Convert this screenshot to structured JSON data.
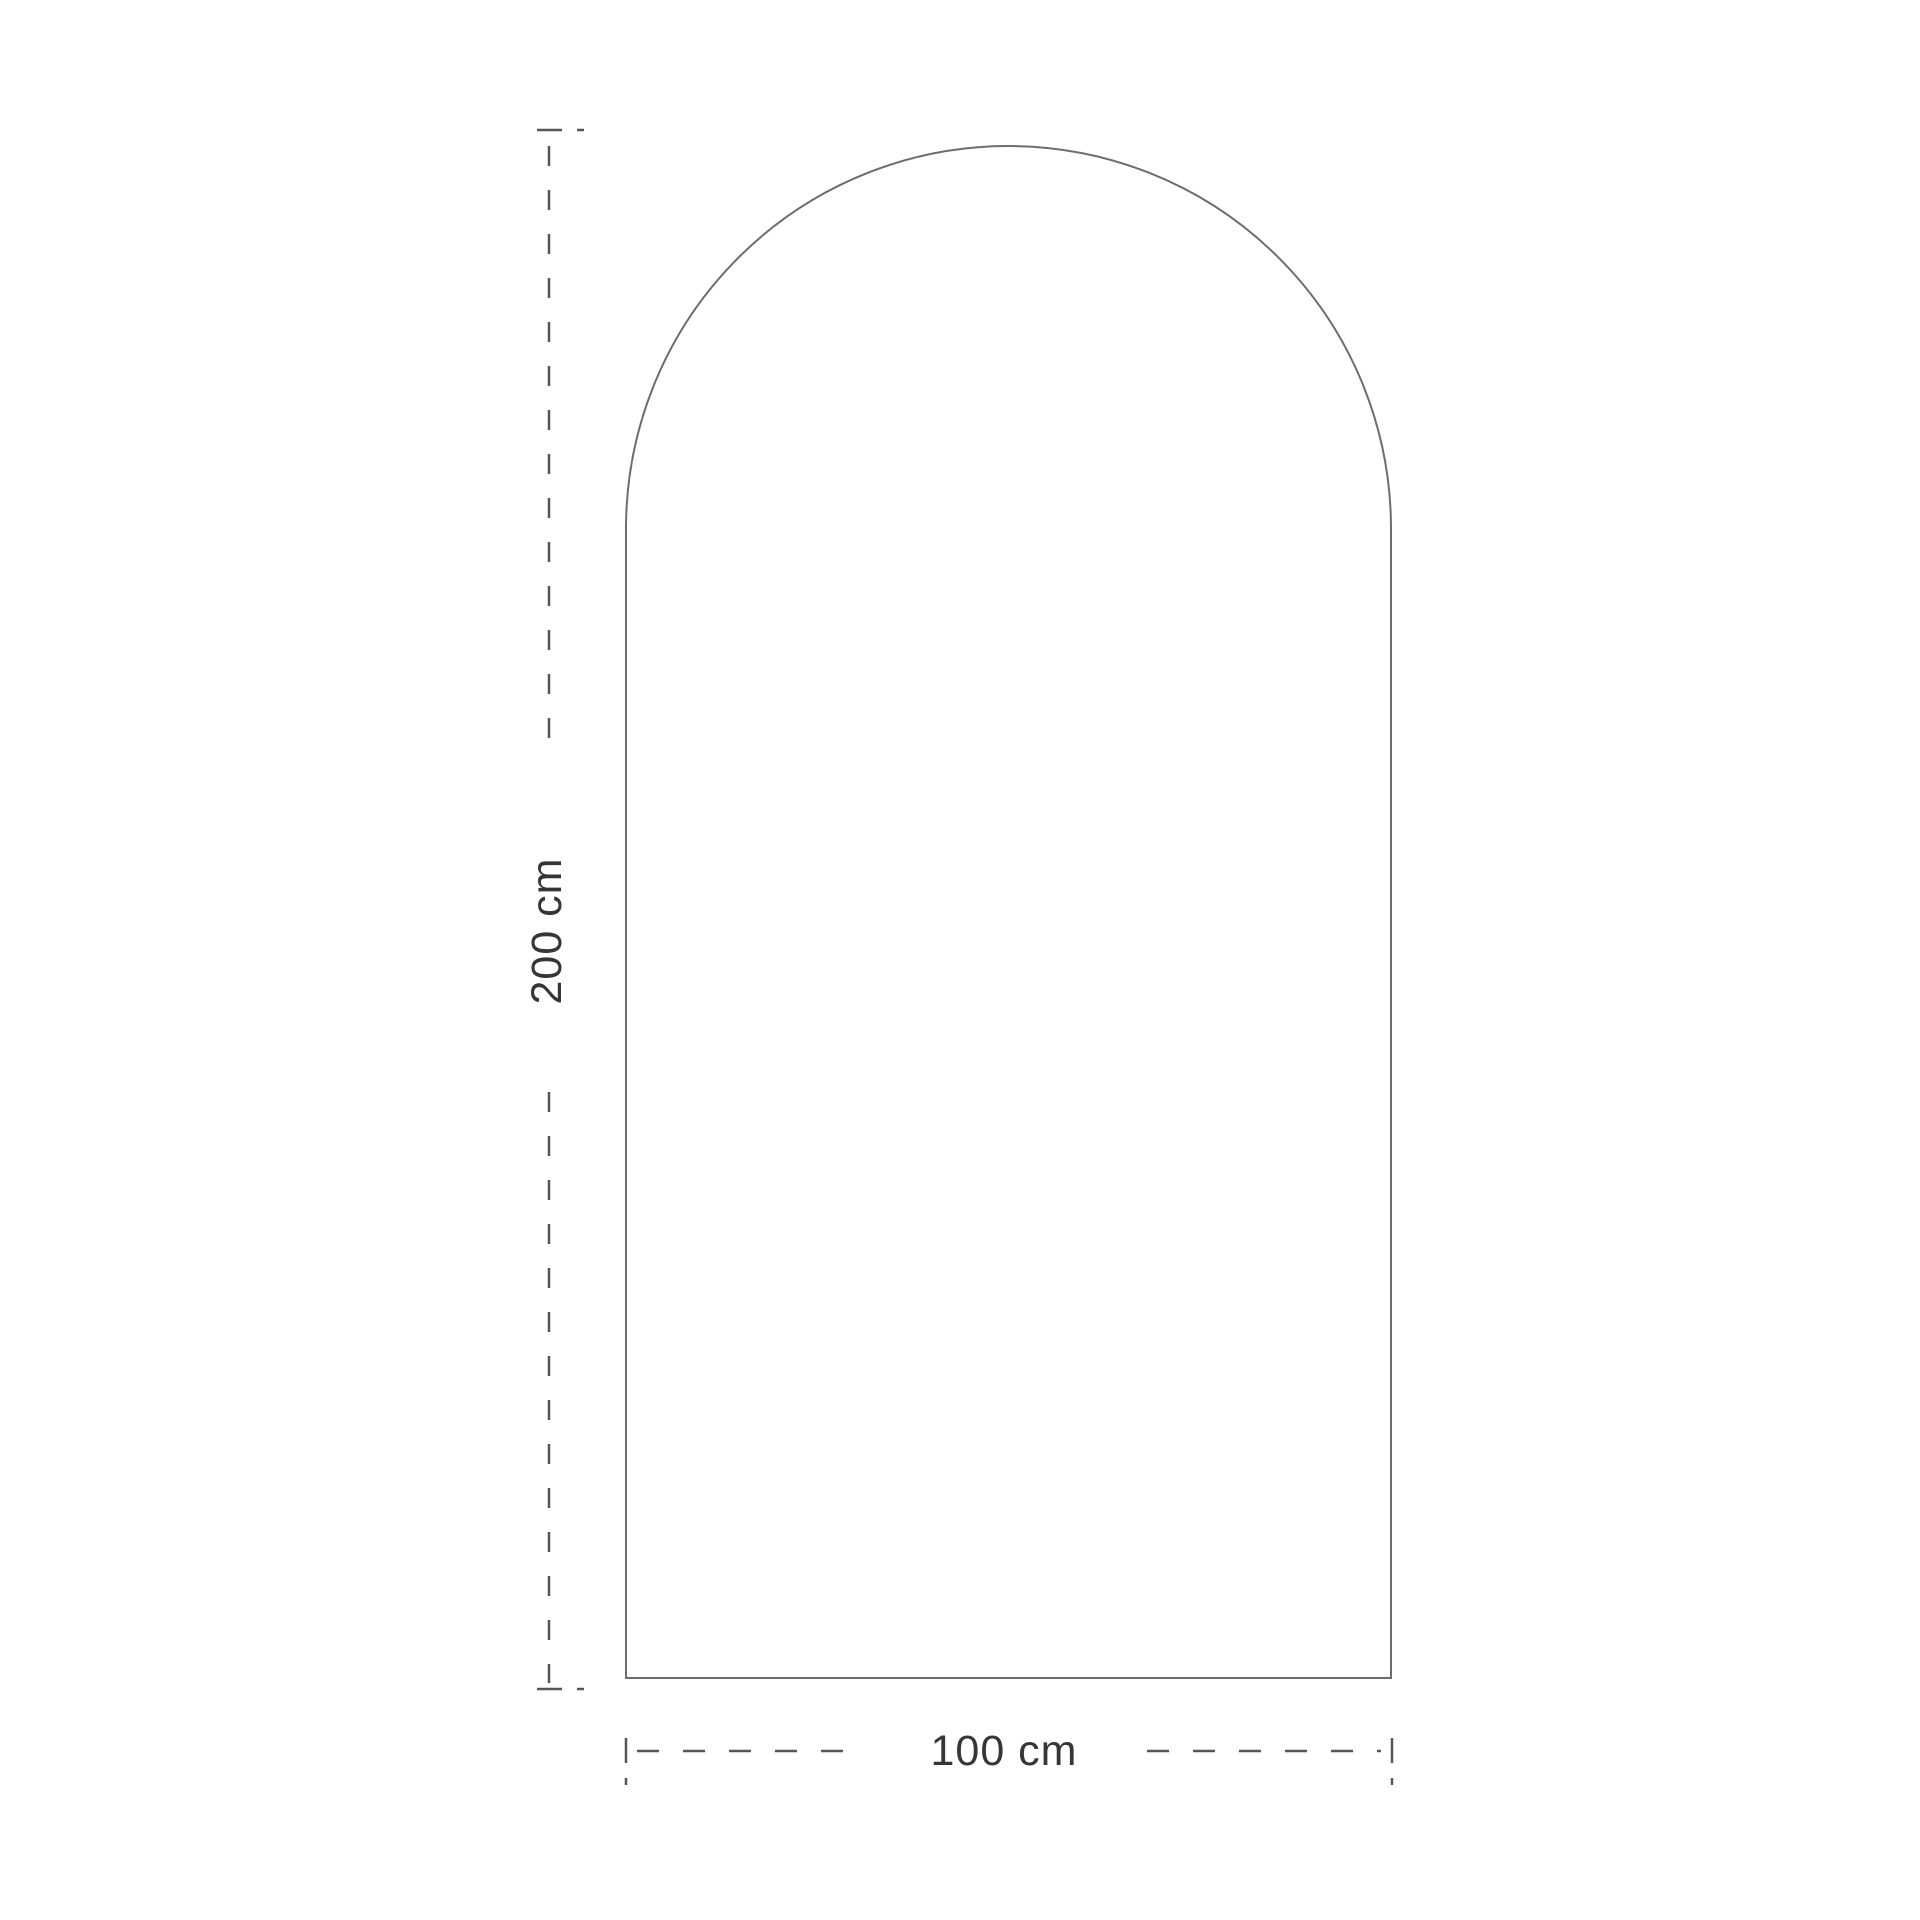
{
  "diagram": {
    "type": "technical-dimension-drawing",
    "shape": "arched-panel",
    "height_dimension": {
      "label": "200 cm",
      "value": 200,
      "unit": "cm",
      "orientation": "vertical"
    },
    "width_dimension": {
      "label": "100 cm",
      "value": 100,
      "unit": "cm",
      "orientation": "horizontal"
    },
    "colors": {
      "outline": "#6b6d70",
      "dimension_line": "#55565a",
      "text": "#363636",
      "background": "#ffffff"
    }
  }
}
